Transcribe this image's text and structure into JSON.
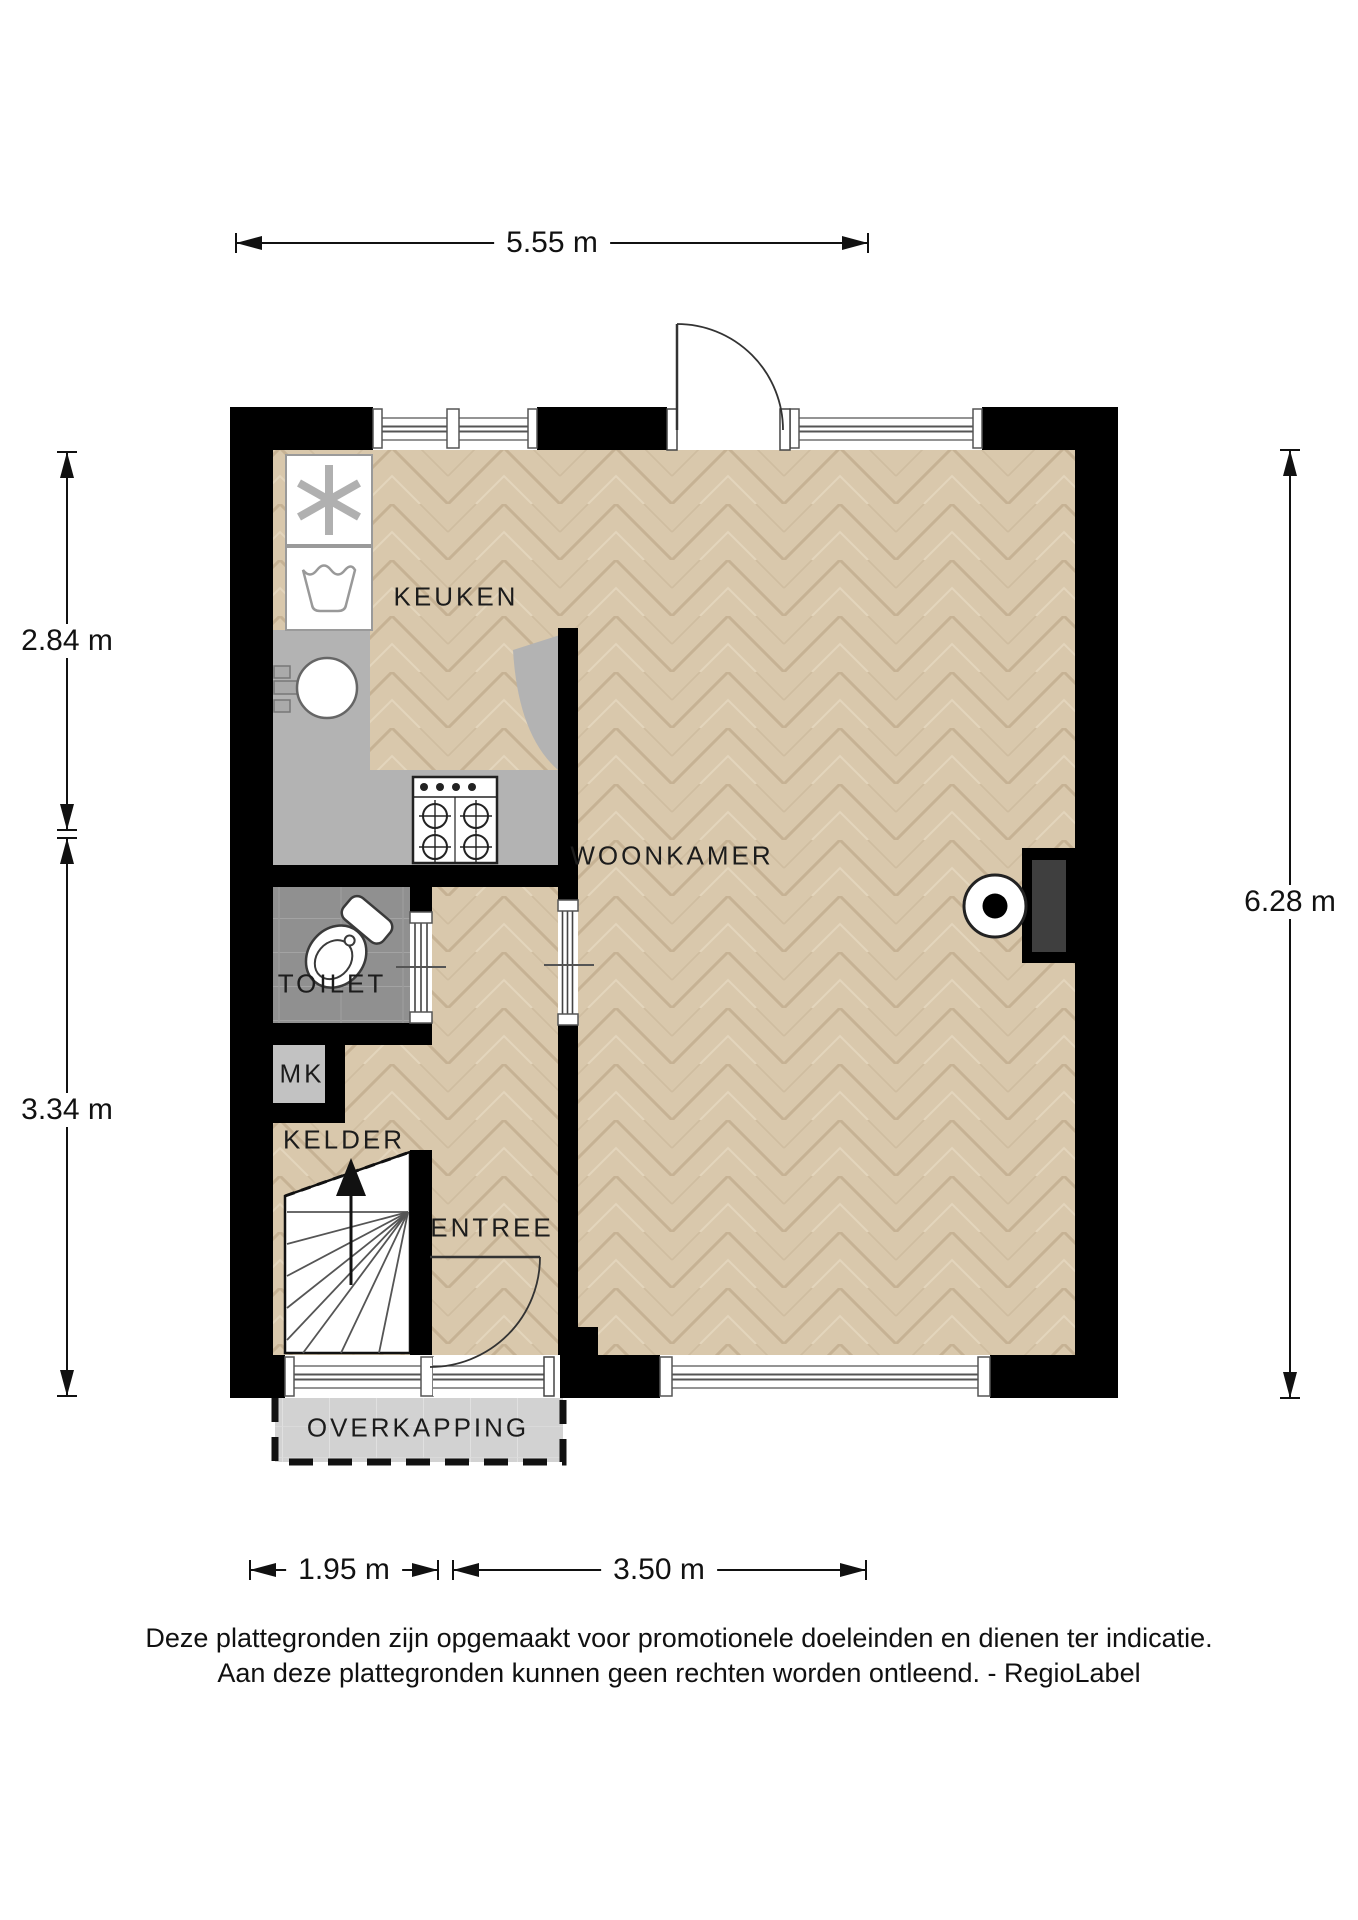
{
  "rooms": {
    "keuken": "KEUKEN",
    "woonkamer": "WOONKAMER",
    "toilet": "TOILET",
    "mk": "MK",
    "kelder": "KELDER",
    "entree": "ENTREE",
    "overkapping": "OVERKAPPING"
  },
  "dimensions": {
    "top": "5.55 m",
    "left_upper": "2.84 m",
    "left_lower": "3.34 m",
    "right": "6.28 m",
    "bottom_left": "1.95 m",
    "bottom_right": "3.50 m"
  },
  "footer": {
    "line1": "Deze plattegronden zijn opgemaakt voor promotionele doeleinden en dienen ter indicatie.",
    "line2": "Aan deze plattegronden kunnen geen rechten worden ontleend. - RegioLabel"
  },
  "colors": {
    "wall": "#000000",
    "wood_floor": "#d9c8ac",
    "wood_joint": "#c6b294",
    "counter_gray": "#b3b3b3",
    "toilet_tile_gray": "#909090",
    "mk_floor_gray": "#c2c2c2",
    "canopy_gray": "#d2d2d2",
    "line_dark": "#333333"
  },
  "icons": {
    "extractor-asterisk-icon": "✻",
    "laundry-tub-icon": "wash-tub outline",
    "sink-icon": "round sink with faucet",
    "stove-icon": "4-burner gas hob",
    "toilet-icon": "toilet with cistern",
    "stairs-up-arrow-icon": "↑",
    "heater-icon": "circle with dot (stove/heater)",
    "door-swing-icon": "quarter-circle door swing"
  }
}
